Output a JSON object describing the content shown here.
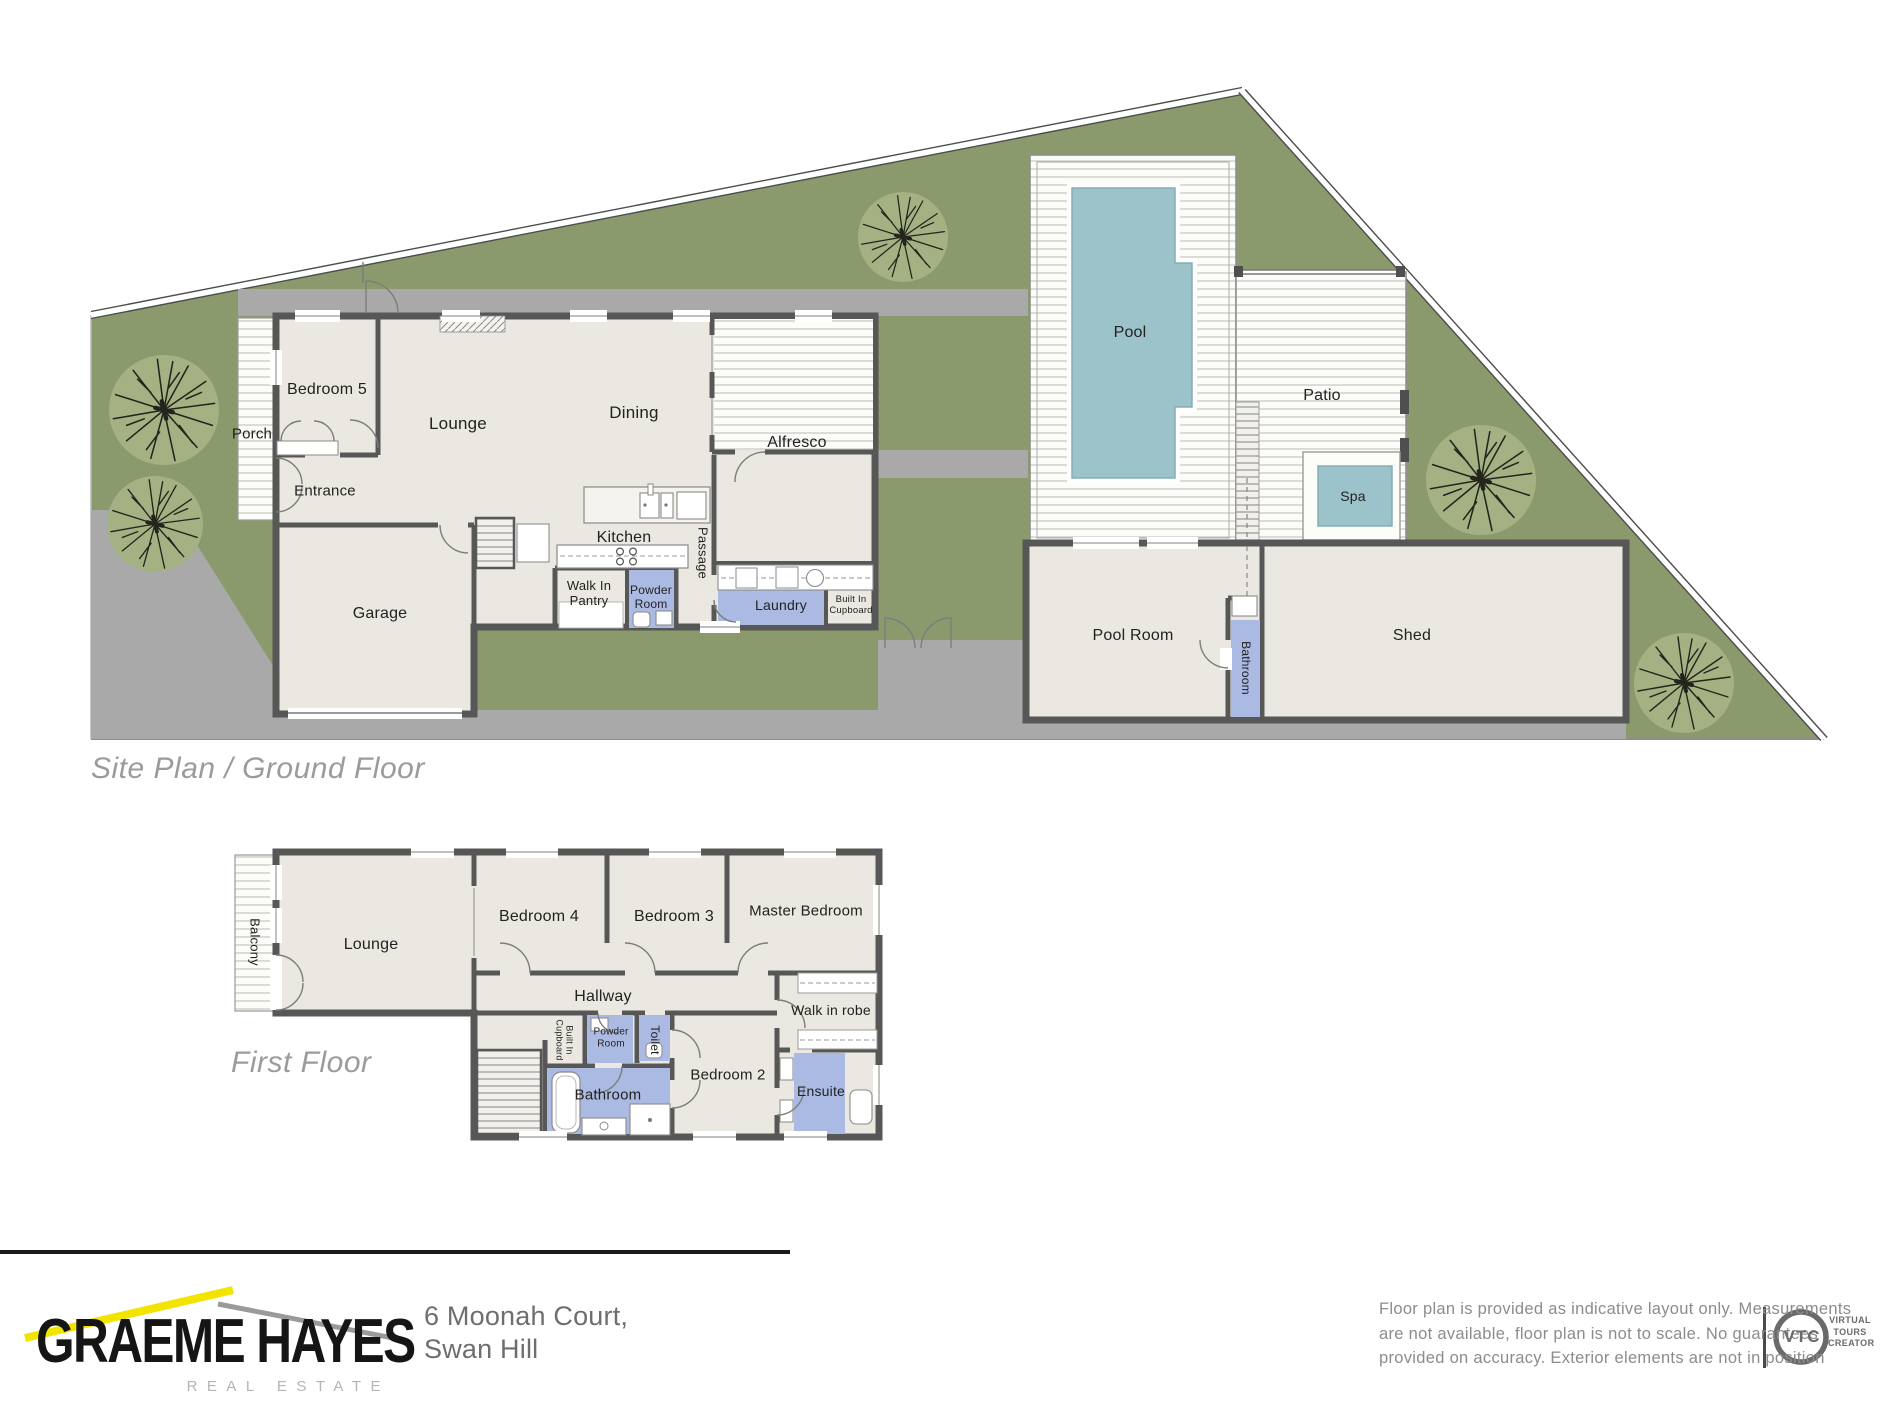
{
  "page_title": "6 Moonah Court Swan Hill floor plan",
  "sections": {
    "site_plan_title": "Site Plan / Ground Floor",
    "first_floor_title": "First Floor"
  },
  "colors": {
    "grass": "#8b9a6c",
    "tree": "#a4b183",
    "floor": "#eae8e0",
    "wall": "#575757",
    "hardscape": "#a9a9a9",
    "water": "#9cc2ca",
    "wetroom": "#abbae3",
    "accent-yellow": "#f3e400",
    "deck-line": "#c6c6bf"
  },
  "plan_labels": [
    {
      "name": "porch",
      "text": "Porch",
      "x": 252,
      "y": 434,
      "size": 15,
      "rot": 0
    },
    {
      "name": "bedroom-5",
      "text": "Bedroom 5",
      "x": 327,
      "y": 390,
      "size": 16,
      "rot": 0
    },
    {
      "name": "lounge-ground",
      "text": "Lounge",
      "x": 458,
      "y": 424,
      "size": 17,
      "rot": 0
    },
    {
      "name": "dining",
      "text": "Dining",
      "x": 634,
      "y": 413,
      "size": 17,
      "rot": 0
    },
    {
      "name": "alfresco",
      "text": "Alfresco",
      "x": 797,
      "y": 443,
      "size": 16,
      "rot": 0
    },
    {
      "name": "entrance",
      "text": "Entrance",
      "x": 325,
      "y": 491,
      "size": 15,
      "rot": 0
    },
    {
      "name": "garage",
      "text": "Garage",
      "x": 380,
      "y": 614,
      "size": 16,
      "rot": 0
    },
    {
      "name": "kitchen",
      "text": "Kitchen",
      "x": 624,
      "y": 538,
      "size": 16,
      "rot": 0
    },
    {
      "name": "passage",
      "text": "Passage",
      "x": 702,
      "y": 553,
      "size": 13,
      "rot": 90
    },
    {
      "name": "walk-in-pantry",
      "text": "Walk In\nPantry",
      "x": 589,
      "y": 594,
      "size": 13,
      "rot": 0
    },
    {
      "name": "powder-room-ground",
      "text": "Powder\nRoom",
      "x": 651,
      "y": 598,
      "size": 12,
      "rot": 0
    },
    {
      "name": "laundry",
      "text": "Laundry",
      "x": 781,
      "y": 605,
      "size": 14,
      "rot": 0
    },
    {
      "name": "built-in-cupboard-ground",
      "text": "Built In\nCupboard",
      "x": 851,
      "y": 606,
      "size": 9.5,
      "rot": 0
    },
    {
      "name": "pool",
      "text": "Pool",
      "x": 1130,
      "y": 333,
      "size": 16,
      "rot": 0
    },
    {
      "name": "patio",
      "text": "Patio",
      "x": 1322,
      "y": 396,
      "size": 16,
      "rot": 0
    },
    {
      "name": "spa",
      "text": "Spa",
      "x": 1353,
      "y": 496,
      "size": 14,
      "rot": 0
    },
    {
      "name": "pool-room",
      "text": "Pool Room",
      "x": 1133,
      "y": 636,
      "size": 16,
      "rot": 0
    },
    {
      "name": "bathroom-ground",
      "text": "Bathroom",
      "x": 1245,
      "y": 668,
      "size": 12,
      "rot": 90
    },
    {
      "name": "shed",
      "text": "Shed",
      "x": 1412,
      "y": 636,
      "size": 16,
      "rot": 0
    },
    {
      "name": "balcony",
      "text": "Balcony",
      "x": 254,
      "y": 942,
      "size": 13,
      "rot": 90
    },
    {
      "name": "lounge-first",
      "text": "Lounge",
      "x": 371,
      "y": 945,
      "size": 16,
      "rot": 0
    },
    {
      "name": "bedroom-4",
      "text": "Bedroom 4",
      "x": 539,
      "y": 917,
      "size": 16,
      "rot": 0
    },
    {
      "name": "bedroom-3",
      "text": "Bedroom 3",
      "x": 674,
      "y": 917,
      "size": 16,
      "rot": 0
    },
    {
      "name": "master-bedroom",
      "text": "Master Bedroom",
      "x": 806,
      "y": 911,
      "size": 15,
      "rot": 0
    },
    {
      "name": "hallway",
      "text": "Hallway",
      "x": 603,
      "y": 997,
      "size": 16,
      "rot": 0
    },
    {
      "name": "walk-in-robe",
      "text": "Walk in robe",
      "x": 831,
      "y": 1010,
      "size": 14,
      "rot": 0
    },
    {
      "name": "built-in-cupboard-first",
      "text": "Built In\nCupboard",
      "x": 564,
      "y": 1040,
      "size": 9,
      "rot": 90
    },
    {
      "name": "powder-room-first",
      "text": "Powder\nRoom",
      "x": 611,
      "y": 1038,
      "size": 10,
      "rot": 0
    },
    {
      "name": "toilet",
      "text": "Toilet",
      "x": 654,
      "y": 1040,
      "size": 12,
      "rot": 90
    },
    {
      "name": "bedroom-2",
      "text": "Bedroom 2",
      "x": 728,
      "y": 1075,
      "size": 15,
      "rot": 0
    },
    {
      "name": "bathroom-first",
      "text": "Bathroom",
      "x": 608,
      "y": 1095,
      "size": 15,
      "rot": 0
    },
    {
      "name": "ensuite",
      "text": "Ensuite",
      "x": 821,
      "y": 1091,
      "size": 14,
      "rot": 0
    }
  ],
  "footer": {
    "brand_name": "GRAEME HAYES",
    "brand_sub": "REAL ESTATE",
    "address_line1": "6 Moonah Court,",
    "address_line2": "Swan Hill",
    "disclaimer_lines": [
      "Floor plan is provided as indicative layout only. Measurements",
      "are not available, floor plan is not to scale. No guarantees",
      "provided on accuracy. Exterior elements are not in position"
    ],
    "vtc_abbr": "VTC",
    "vtc_lines": [
      "VIRTUAL",
      "TOURS",
      "CREATOR"
    ]
  }
}
